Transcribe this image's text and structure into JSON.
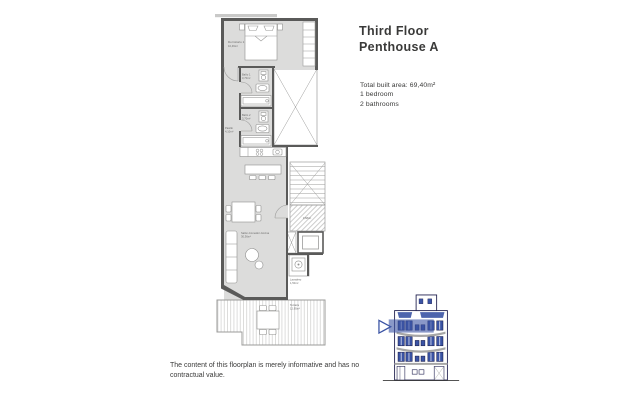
{
  "header": {
    "title_line1": "Third Floor",
    "title_line2": "Penthouse A"
  },
  "summary": {
    "built_area": "Total built area: 69,40m²",
    "bedrooms": "1 bedroom",
    "bathrooms": "2 bathrooms"
  },
  "disclaimer": "The content of this floorplan is merely informative and has no contractual value.",
  "floorplan": {
    "rooms": [
      {
        "name": "Dormitorio 1",
        "area": "10,46m²"
      },
      {
        "name": "Baño 1",
        "area": "3,70m²"
      },
      {
        "name": "Baño 2",
        "area": "3,70m²"
      },
      {
        "name": "Pasillo",
        "area": "4,10m²"
      },
      {
        "name": "Salón-Comedor-Cocina",
        "area": "30,36m²"
      },
      {
        "name": "Rellano",
        "area": "3,68m²"
      },
      {
        "name": "Lavadero",
        "area": "1,50m²"
      },
      {
        "name": "Terraza",
        "area": "12,95m²"
      }
    ]
  },
  "minimap": {
    "icon": "building-elevation-icon",
    "highlighted_floor": "third-floor"
  },
  "colors": {
    "accent_blue": "#3a53a4",
    "wall_gray": "#5a5a59",
    "floor_gray": "#dcdcdb",
    "text": "#3a3a39"
  }
}
